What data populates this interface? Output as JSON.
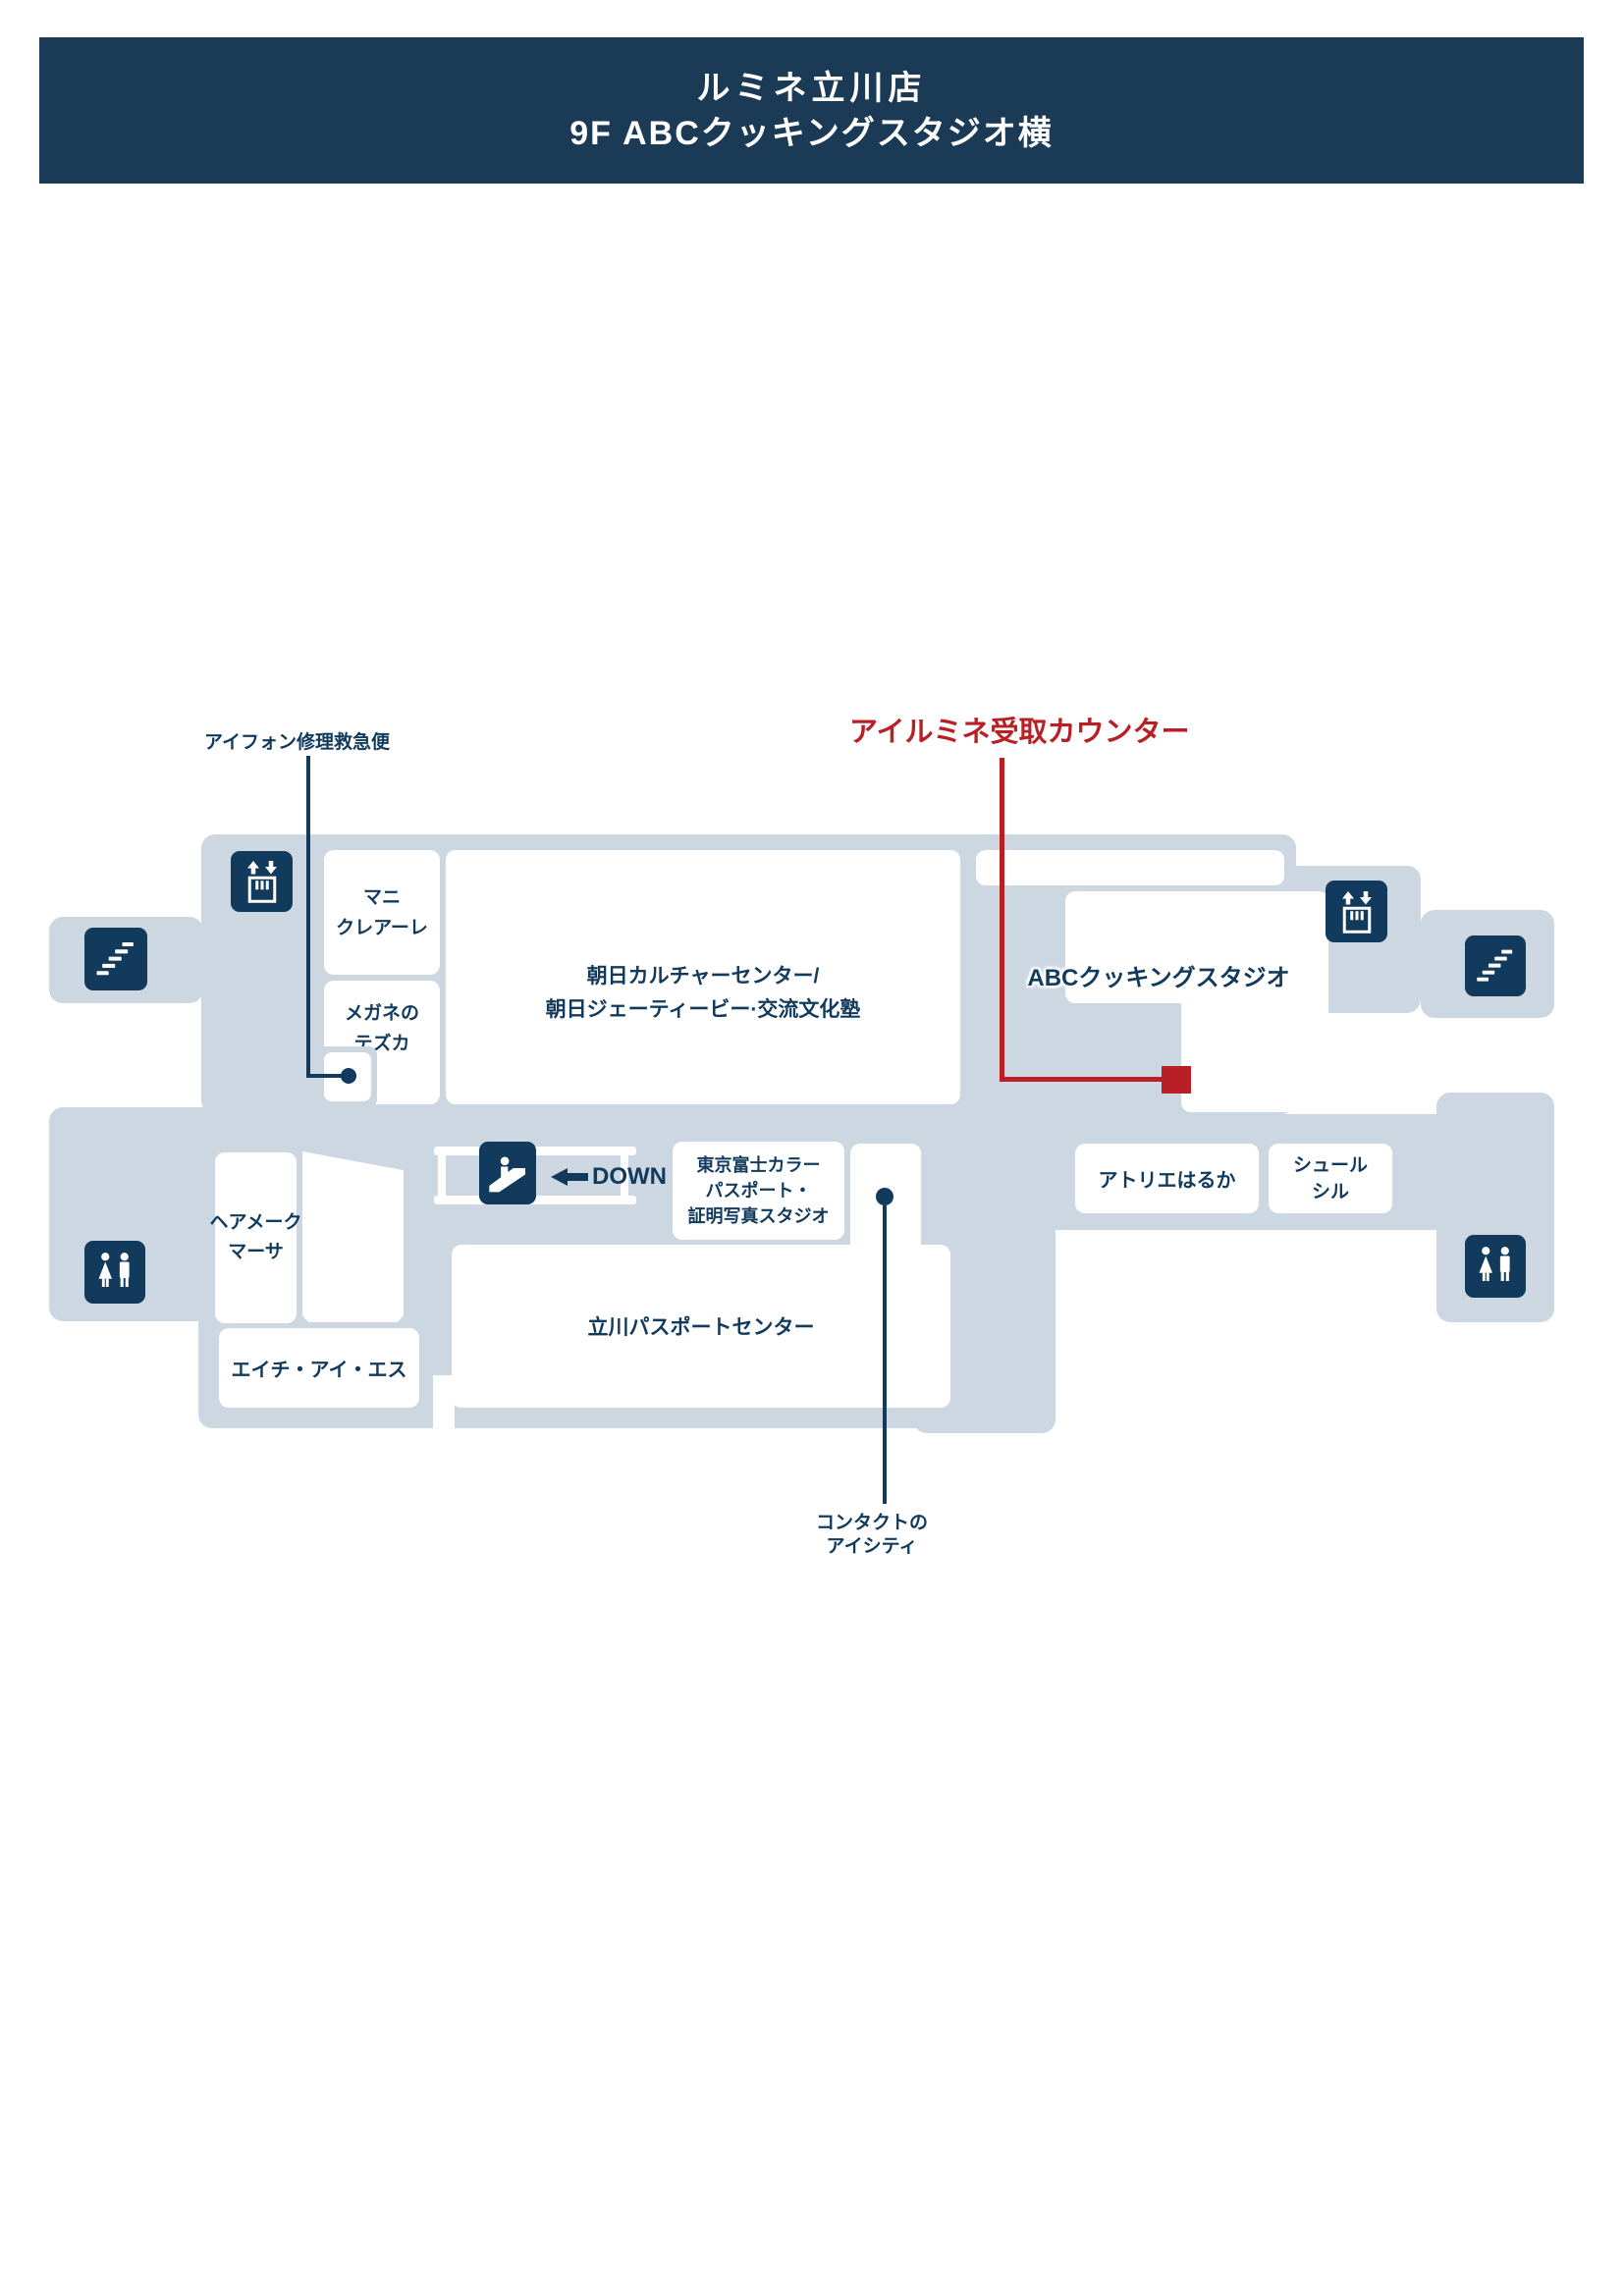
{
  "header": {
    "title": "ルミネ立川店",
    "subtitle": "9F ABCクッキングスタジオ横"
  },
  "annotations": {
    "iphone_repair": {
      "label": "アイフォン修理救急便"
    },
    "ailumine_pickup": {
      "label": "アイルミネ受取カウンター"
    },
    "eyecity": {
      "line1": "コンタクトの",
      "line2": "アイシティ"
    },
    "escalator_direction": {
      "label": "DOWN"
    }
  },
  "rooms": {
    "mani": {
      "line1": "マニ",
      "line2": "クレアーレ"
    },
    "megane": {
      "line1": "メガネの",
      "line2": "テズカ"
    },
    "asahi": {
      "line1": "朝日カルチャーセンター/",
      "line2": "朝日ジェーティービー·交流文化塾"
    },
    "abc": {
      "label": "ABCクッキングスタジオ"
    },
    "tokyo_fuji": {
      "line1": "東京富士カラー",
      "line2": "パスポート・",
      "line3": "証明写真スタジオ"
    },
    "atelier": {
      "label": "アトリエはるか"
    },
    "surle_sil": {
      "line1": "シュール",
      "line2": "シル"
    },
    "hair_make": {
      "line1": "ヘアメーク",
      "line2": "マーサ"
    },
    "his": {
      "label": "エイチ・アイ・エス"
    },
    "passport": {
      "label": "立川パスポートセンター"
    }
  },
  "icons": {
    "elevator": "elevator-icon",
    "stairs": "stairs-icon",
    "restroom": "restroom-icon",
    "escalator": "escalator-icon",
    "down_arrow": "arrow-left-icon",
    "location_dot": "location-dot-icon",
    "pickup_marker": "pickup-square-marker"
  },
  "colors": {
    "header_bg": "#1b3a55",
    "navy": "#113a5c",
    "floor": "#ccd7e2",
    "accent_red": "#b82025",
    "room_white": "#ffffff"
  }
}
